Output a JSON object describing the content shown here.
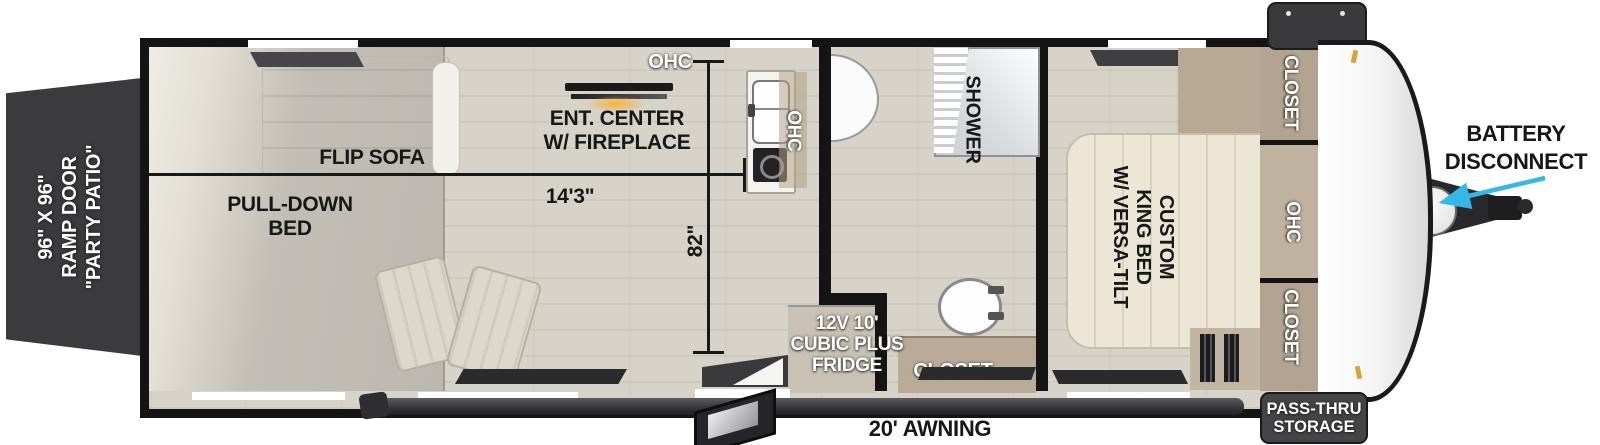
{
  "ramp_door": {
    "line1": "96\" X 96\"",
    "line2": "RAMP DOOR",
    "line3": "\"PARTY PATIO\""
  },
  "garage": {
    "flip_sofa": "FLIP SOFA",
    "pull_down_bed_line1": "PULL-DOWN",
    "pull_down_bed_line2": "BED",
    "dim_length": "14'3\"",
    "dim_width": "82\""
  },
  "living": {
    "ohc_top": "OHC",
    "ent_center_line1": "ENT. CENTER",
    "ent_center_line2": "W/ FIREPLACE",
    "ohc_kitchen": "OHC"
  },
  "bathroom": {
    "shower": "SHOWER",
    "closet": "CLOSET",
    "fridge_line1": "12V 10'",
    "fridge_line2": "CUBIC PLUS",
    "fridge_line3": "FRIDGE"
  },
  "bedroom": {
    "bed_line1": "CUSTOM",
    "bed_line2": "KING BED",
    "bed_line3": "W/ VERSA-TILT",
    "closet_top": "CLOSET",
    "ohc": "OHC",
    "closet_bottom": "CLOSET"
  },
  "front": {
    "battery_line1": "BATTERY",
    "battery_line2": "DISCONNECT",
    "pass_thru_line1": "PASS-THRU",
    "pass_thru_line2": "STORAGE"
  },
  "awning": {
    "label": "20' AWNING"
  },
  "colors": {
    "wall": "#141414",
    "floor": "#d7d3c8",
    "garage_floor": "#c3bfb6",
    "tan": "#b2a490",
    "bed": "#ebe6d6",
    "ramp_door": "#3b3b3d",
    "awning_bar": "#3e3e41",
    "arrow_accent": "#35b8e8",
    "fireplace_glow": "#fcb028"
  }
}
